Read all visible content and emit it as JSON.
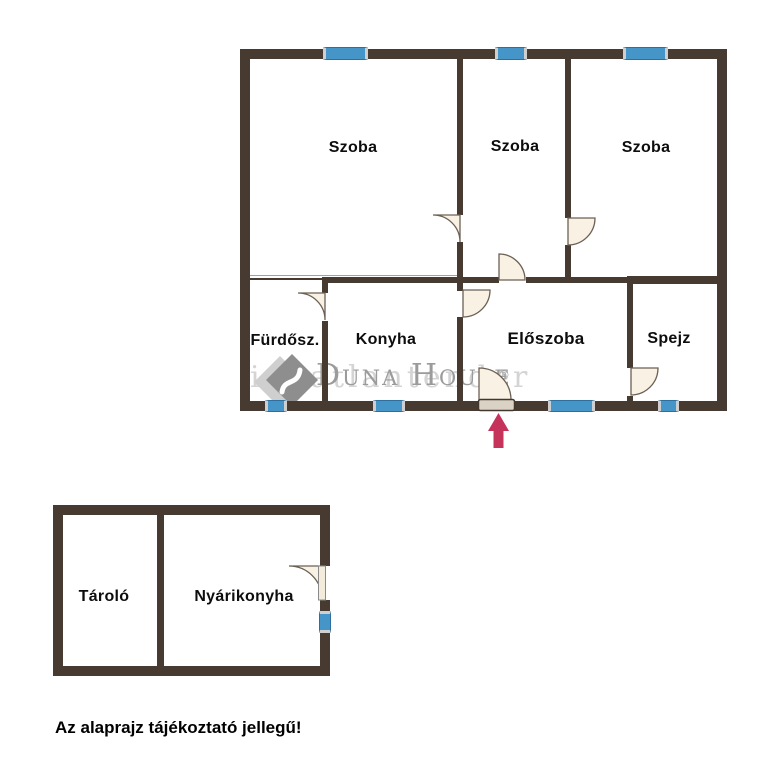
{
  "disclaimer": "Az alaprajz tájékoztató jellegű!",
  "watermark": {
    "brand": "Duna House",
    "registered_mark": "®",
    "underlay_text": "ingatlantender"
  },
  "main_building": {
    "rooms": [
      {
        "id": "szoba-1",
        "label": "Szoba"
      },
      {
        "id": "szoba-2",
        "label": "Szoba"
      },
      {
        "id": "szoba-3",
        "label": "Szoba"
      },
      {
        "id": "furdoszoba",
        "label": "Fürdősz."
      },
      {
        "id": "konyha",
        "label": "Konyha"
      },
      {
        "id": "eloszoba",
        "label": "Előszoba"
      },
      {
        "id": "spejz",
        "label": "Spejz"
      }
    ]
  },
  "outbuilding": {
    "rooms": [
      {
        "id": "tarolo",
        "label": "Tároló"
      },
      {
        "id": "nyarikonyha",
        "label": "Nyárikonyha"
      }
    ]
  },
  "icons": {
    "entrance_arrow": "up-arrow",
    "door_swing": "quarter-circle-door",
    "logo": "duna-house-diamond"
  },
  "colors": {
    "wall": "#473a30",
    "window_fill": "#4695c8",
    "window_border": "#2d6f9e",
    "door_fill": "#f8f1e4",
    "door_stroke": "#6b6054",
    "entrance_arrow": "#c5335a",
    "label_text": "#0d0d0d",
    "watermark_gray": "#9b9b9b",
    "watermark_light": "#d4d4d4"
  }
}
